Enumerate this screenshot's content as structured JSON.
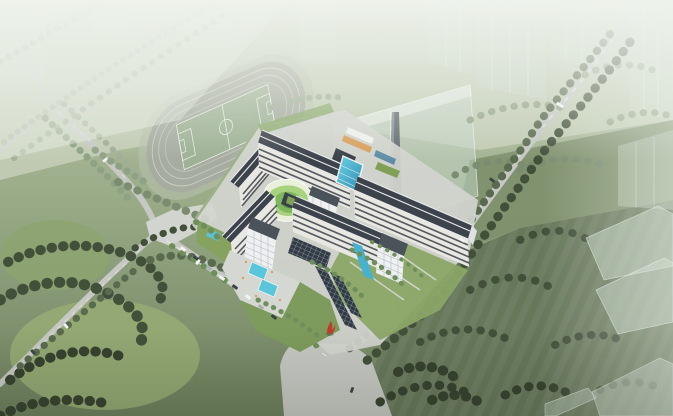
{
  "scene": {
    "title": "Aerial architectural rendering of a hospital campus",
    "description": "Bird's-eye perspective render: multi-slab hospital complex with courtyards, terraced green building, pool bridge and solar walkways; running track with soccer pitch at upper left; tree-lined roads; roundabout with red sculpture; translucent future-phase buildings; hazy horizon at top.",
    "elements": [
      "running-track",
      "soccer-field",
      "hospital-complex",
      "entrance-roundabout",
      "red-sculpture",
      "ghost-buildings",
      "chimney",
      "tree-rows",
      "meadows",
      "roads",
      "parked-cars",
      "entrance-pools",
      "terraced-green-building",
      "pool-bridge",
      "solar-walkway"
    ]
  },
  "colors": {
    "hazeTop": "#f0f4ee",
    "groundTop": "#c6cfb8",
    "groundMid": "#9cad8a",
    "groundBottom": "#6d7f5c",
    "meadow": "#66775a",
    "meadowLight": "#7d8f6c",
    "lawnBright": "#93a873",
    "road": "#c6c9c3",
    "roadLight": "#d4d7d0",
    "roadDash": "#ffffff",
    "paving": "#d2d5cf",
    "trackLanes": "#a7aca0",
    "trackApron": "#b5bfac",
    "laneLine": "#dfe3db",
    "pitch": "#9eb295",
    "pitchLine": "#e9ede4",
    "roofDark": "#3d434b",
    "roofTrim": "#e8eaec",
    "facadeLight": "#e9e7e1",
    "facadeDark": "#3a4149",
    "towerWhite": "#eef0f2",
    "glassBlue": "#49b8d8",
    "poolBlue": "#59c6dc",
    "streamBlue": "#45b2d0",
    "lapPool": "#3fa8c8",
    "terraceLight": "#e8f0da",
    "terraceMid": "#a9d27f",
    "terraceDeep": "#7fb75c",
    "terraceDark": "#5f9b44",
    "courtGreen": "#7fa055",
    "gardenGreen": "#85a35f",
    "campusTree": "#6f8f5a",
    "solarDark": "#2f3a45",
    "canopyDark": "#323c46",
    "deckTan": "#d9a05c",
    "ghostFill": "rgba(200,215,202,0.5)",
    "ghostTop": "rgba(238,244,238,0.55)",
    "ghostEdge": "rgba(252,253,251,0.7)",
    "chimney": "#646c73",
    "treeDark": "#42503a",
    "treeDarkest": "#36422e",
    "treeMid": "#5a6a4e",
    "treeLight": "#8fa284",
    "treePale": "#aebba6",
    "sculptureRed": "#c23b2a",
    "carWhite": "#f2f4f2",
    "carDark": "#3c4248",
    "carGray": "#aab0b4"
  }
}
